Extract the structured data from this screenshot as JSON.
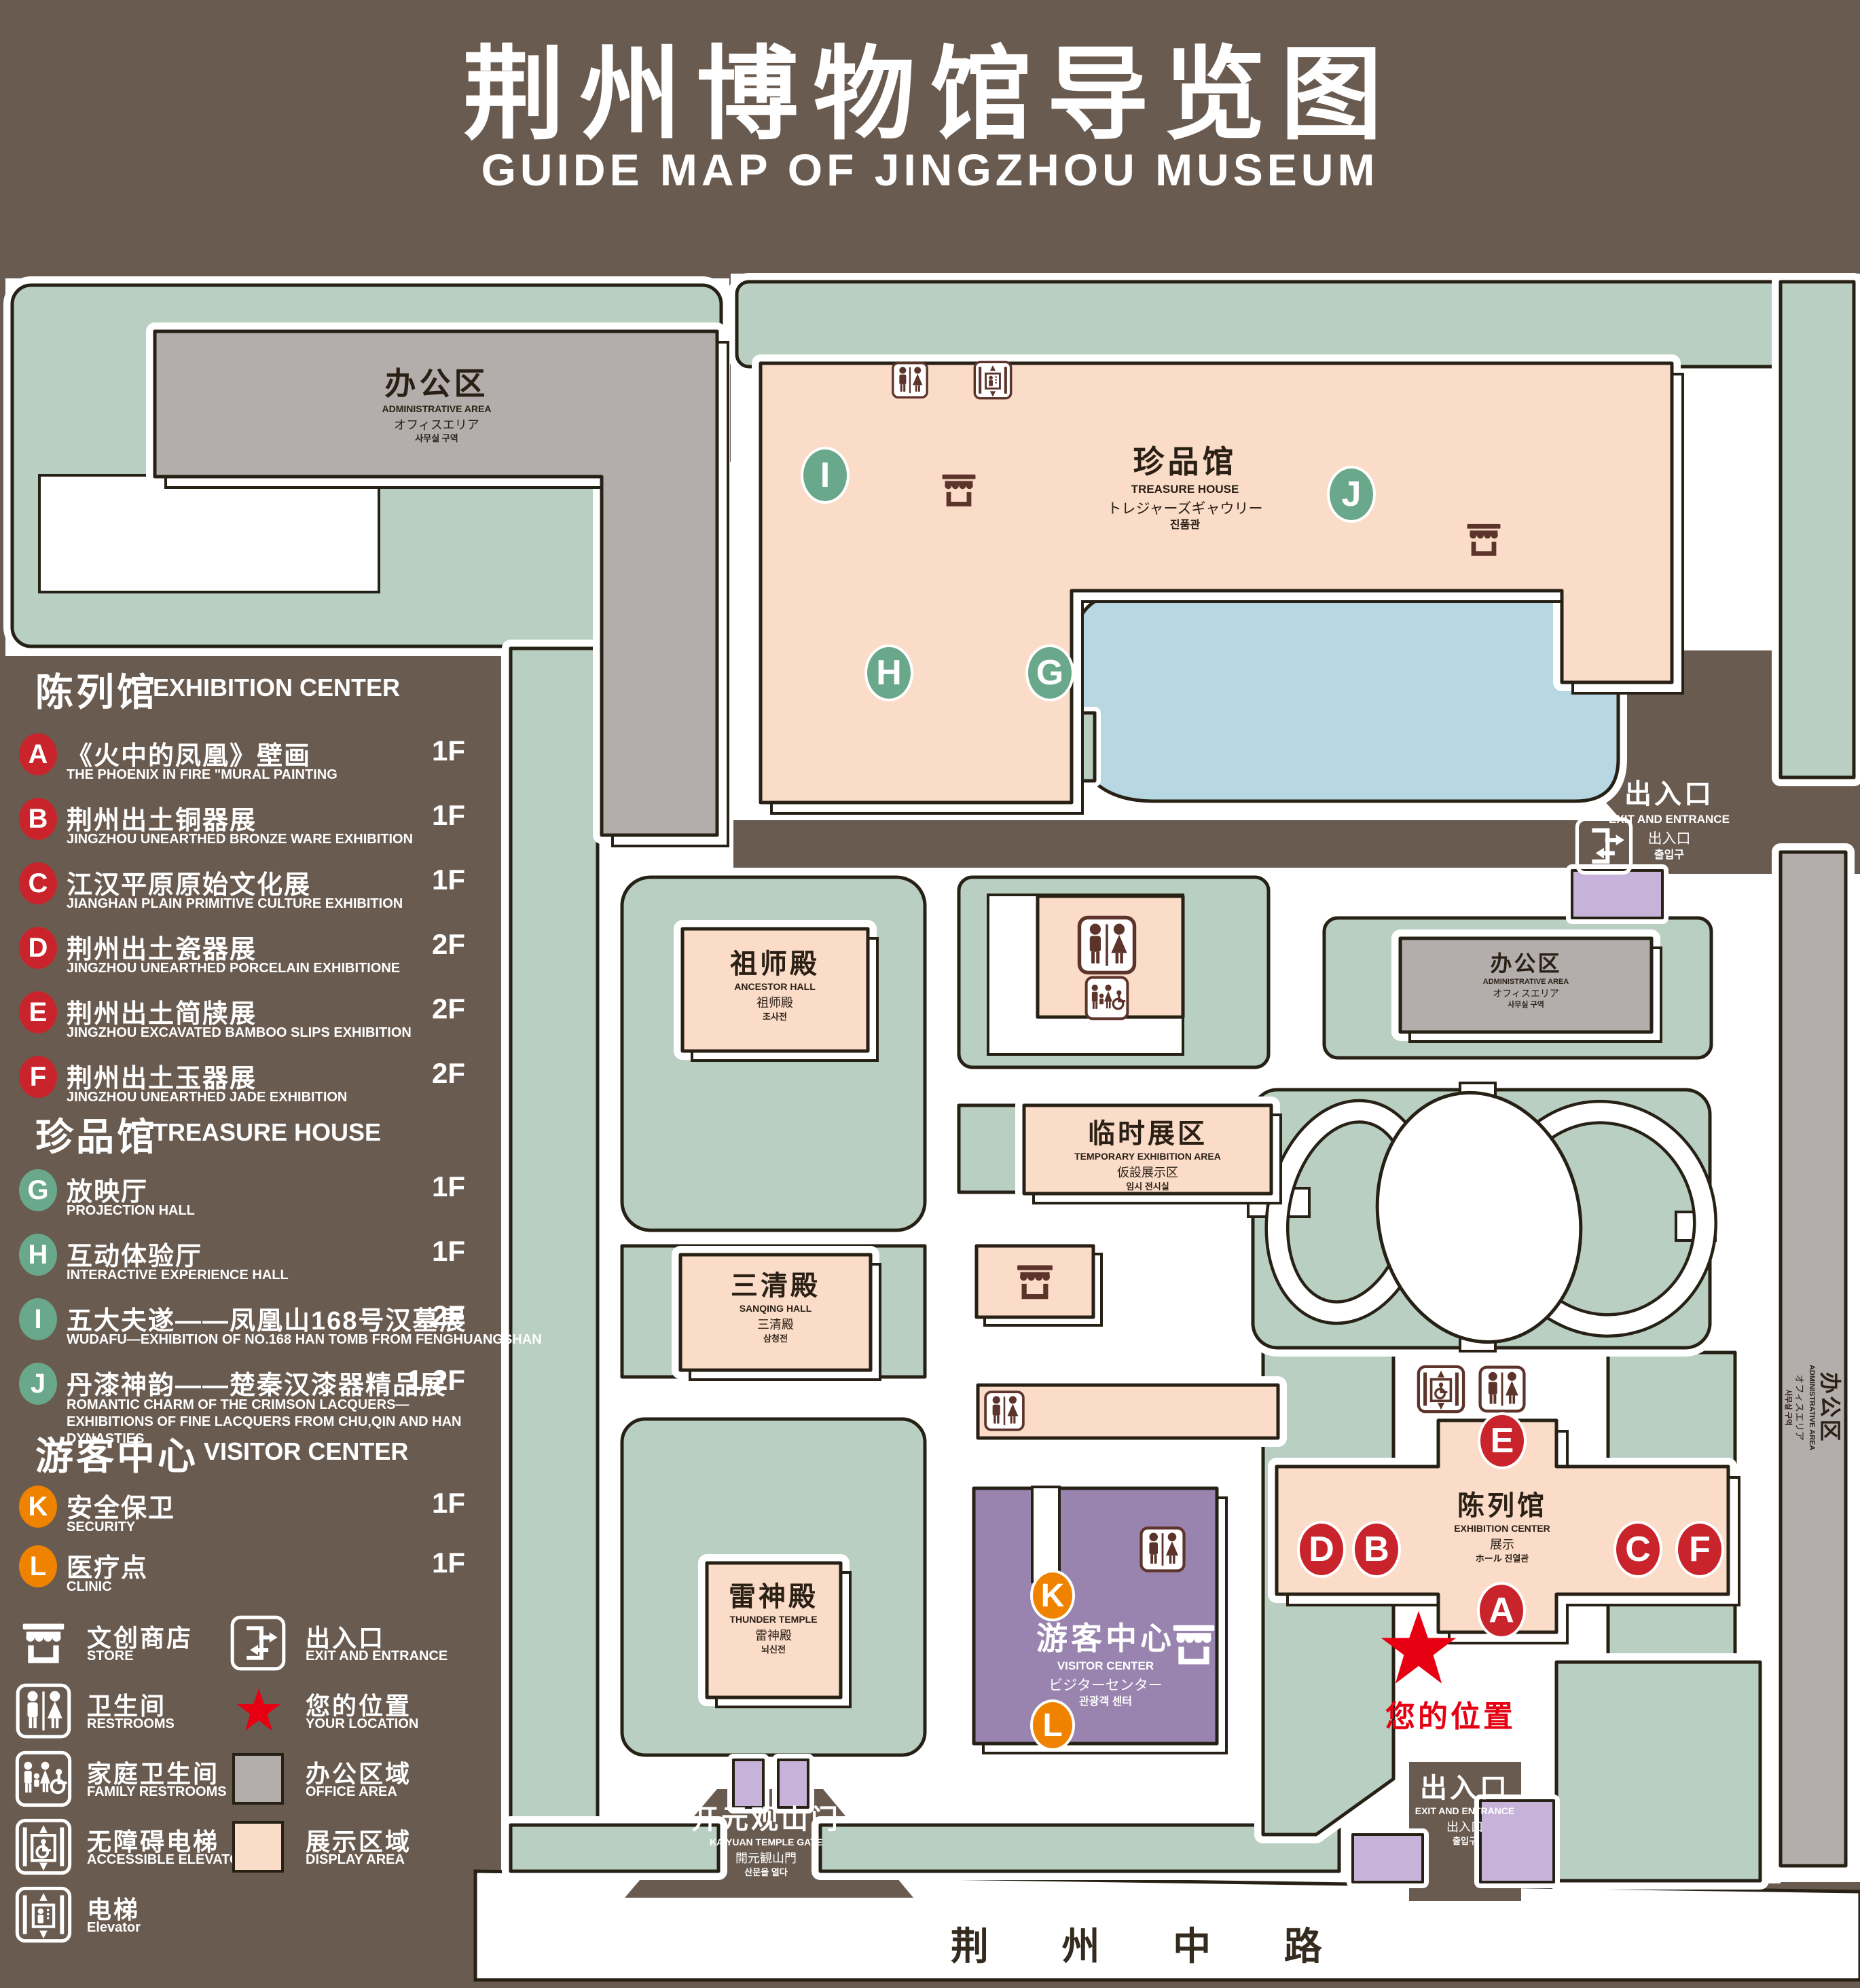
{
  "title": {
    "zh": "荆州博物馆导览图",
    "en": "GUIDE MAP OF JINGZHOU MUSEUM"
  },
  "colors": {
    "background": "#6a5b50",
    "green_area": "#b9cfc2",
    "display_area_pink": "#fadcc8",
    "office_gray": "#b3aeab",
    "pond_blue": "#b7d7e3",
    "visitor_purple": "#9884ae",
    "gate_lavender": "#c7b3d9",
    "red_badge": "#c9242b",
    "green_badge": "#69a88b",
    "orange_badge": "#ef8300",
    "location_red": "#e60012",
    "outline": "#262015",
    "icon_brown": "#5d342b"
  },
  "legend": {
    "sections": [
      {
        "title_zh": "陈列馆",
        "title_en": "EXHIBITION CENTER",
        "items": [
          {
            "letter": "A",
            "zh": "《火中的凤凰》壁画",
            "en": "THE PHOENIX IN FIRE \"MURAL PAINTING",
            "floor": "1F"
          },
          {
            "letter": "B",
            "zh": "荆州出土铜器展",
            "en": "JINGZHOU UNEARTHED BRONZE WARE EXHIBITION",
            "floor": "1F"
          },
          {
            "letter": "C",
            "zh": "江汉平原原始文化展",
            "en": "JIANGHAN PLAIN PRIMITIVE CULTURE EXHIBITION",
            "floor": "1F"
          },
          {
            "letter": "D",
            "zh": "荆州出土瓷器展",
            "en": "JINGZHOU UNEARTHED PORCELAIN EXHIBITIONE",
            "floor": "2F"
          },
          {
            "letter": "E",
            "zh": "荆州出土简牍展",
            "en": "JINGZHOU EXCAVATED BAMBOO SLIPS EXHIBITION",
            "floor": "2F"
          },
          {
            "letter": "F",
            "zh": "荆州出土玉器展",
            "en": "JINGZHOU UNEARTHED JADE EXHIBITION",
            "floor": "2F"
          }
        ]
      },
      {
        "title_zh": "珍品馆",
        "title_en": "TREASURE HOUSE",
        "items": [
          {
            "letter": "G",
            "zh": "放映厅",
            "en": "PROJECTION HALL",
            "floor": "1F"
          },
          {
            "letter": "H",
            "zh": "互动体验厅",
            "en": "INTERACTIVE EXPERIENCE HALL",
            "floor": "1F"
          },
          {
            "letter": "I",
            "zh": "五大夫遂——凤凰山168号汉墓展",
            "en": "WUDAFU—EXHIBITION OF NO.168 HAN TOMB FROM FENGHUANGSHAN",
            "floor": "2F"
          },
          {
            "letter": "J",
            "zh": "丹漆神韵——楚秦汉漆器精品展",
            "en": "ROMANTIC CHARM OF THE CRIMSON LACQUERS—EXHIBITIONS OF FINE LACQUERS FROM CHU,QIN AND HAN DYNASTIES",
            "floor": "1-2F"
          }
        ]
      },
      {
        "title_zh": "游客中心",
        "title_en": "VISITOR CENTER",
        "items": [
          {
            "letter": "K",
            "zh": "安全保卫",
            "en": "SECURITY",
            "floor": "1F"
          },
          {
            "letter": "L",
            "zh": "医疗点",
            "en": "CLINIC",
            "floor": "1F"
          }
        ]
      }
    ],
    "symbols": [
      {
        "zh": "文创商店",
        "en": "STORE"
      },
      {
        "zh": "出入口",
        "en": "EXIT AND ENTRANCE"
      },
      {
        "zh": "卫生间",
        "en": "RESTROOMS"
      },
      {
        "zh": "您的位置",
        "en": "YOUR LOCATION"
      },
      {
        "zh": "家庭卫生间",
        "en": "FAMILY RESTROOMS"
      },
      {
        "zh": "办公区域",
        "en": "OFFICE AREA"
      },
      {
        "zh": "无障碍电梯",
        "en": "ACCESSIBLE ELEVATOR"
      },
      {
        "zh": "展示区域",
        "en": "DISPLAY AREA"
      },
      {
        "zh": "电梯",
        "en": "Elevator"
      }
    ]
  },
  "map": {
    "labels": {
      "admin_nw": {
        "zh": "办公区",
        "en": "ADMINISTRATIVE AREA",
        "ja": "オフィスエリア",
        "ko": "사무실 구역"
      },
      "treasure": {
        "zh": "珍品馆",
        "en": "TREASURE HOUSE",
        "ja": "トレジャーズギャウリー",
        "ko": "진품관"
      },
      "exit_ne": {
        "zh": "出入口",
        "en": "EXIT AND ENTRANCE",
        "ja": "出入口",
        "ko": "출입구"
      },
      "admin_e": {
        "zh": "办公区",
        "en": "ADMINISTRATIVE AREA",
        "ja": "オフィスエリア",
        "ko": "사무실 구역"
      },
      "admin_strip": {
        "zh": "办公区",
        "en": "ADMINISTRATIVE AREA",
        "ja": "オフィスエリア",
        "ko": "사무실 구역"
      },
      "ancestor": {
        "zh": "祖师殿",
        "en": "ANCESTOR HALL",
        "ja": "祖师殿",
        "ko": "조사전"
      },
      "temporary": {
        "zh": "临时展区",
        "en": "TEMPORARY EXHIBITION AREA",
        "ja": "仮設展示区",
        "ko": "임시 전시실"
      },
      "sanqing": {
        "zh": "三清殿",
        "en": "SANQING HALL",
        "ja": "三清殿",
        "ko": "삼청전"
      },
      "thunder": {
        "zh": "雷神殿",
        "en": "THUNDER TEMPLE",
        "ja": "雷神殿",
        "ko": "뇌신전"
      },
      "visitor": {
        "zh": "游客中心",
        "en": "VISITOR CENTER",
        "ja": "ビジターセンター",
        "ko": "관광객 센터"
      },
      "exhibition": {
        "zh": "陈列馆",
        "en": "EXHIBITION CENTER",
        "ja": "展示",
        "ko": "ホール 진열관"
      },
      "gate": {
        "zh": "开元观山门",
        "en": "KAIYUAN TEMPLE GATE",
        "ja": "開元観山門",
        "ko": "산문을 열다"
      },
      "exit_s": {
        "zh": "出入口",
        "en": "EXIT AND ENTRANCE",
        "ja": "出入口",
        "ko": "출입구"
      },
      "road": "荆 州 中 路",
      "your_location": "您的位置"
    },
    "markers": [
      {
        "letter": "A"
      },
      {
        "letter": "B"
      },
      {
        "letter": "C"
      },
      {
        "letter": "D"
      },
      {
        "letter": "E"
      },
      {
        "letter": "F"
      },
      {
        "letter": "G"
      },
      {
        "letter": "H"
      },
      {
        "letter": "I"
      },
      {
        "letter": "J"
      },
      {
        "letter": "K"
      },
      {
        "letter": "L"
      }
    ]
  }
}
